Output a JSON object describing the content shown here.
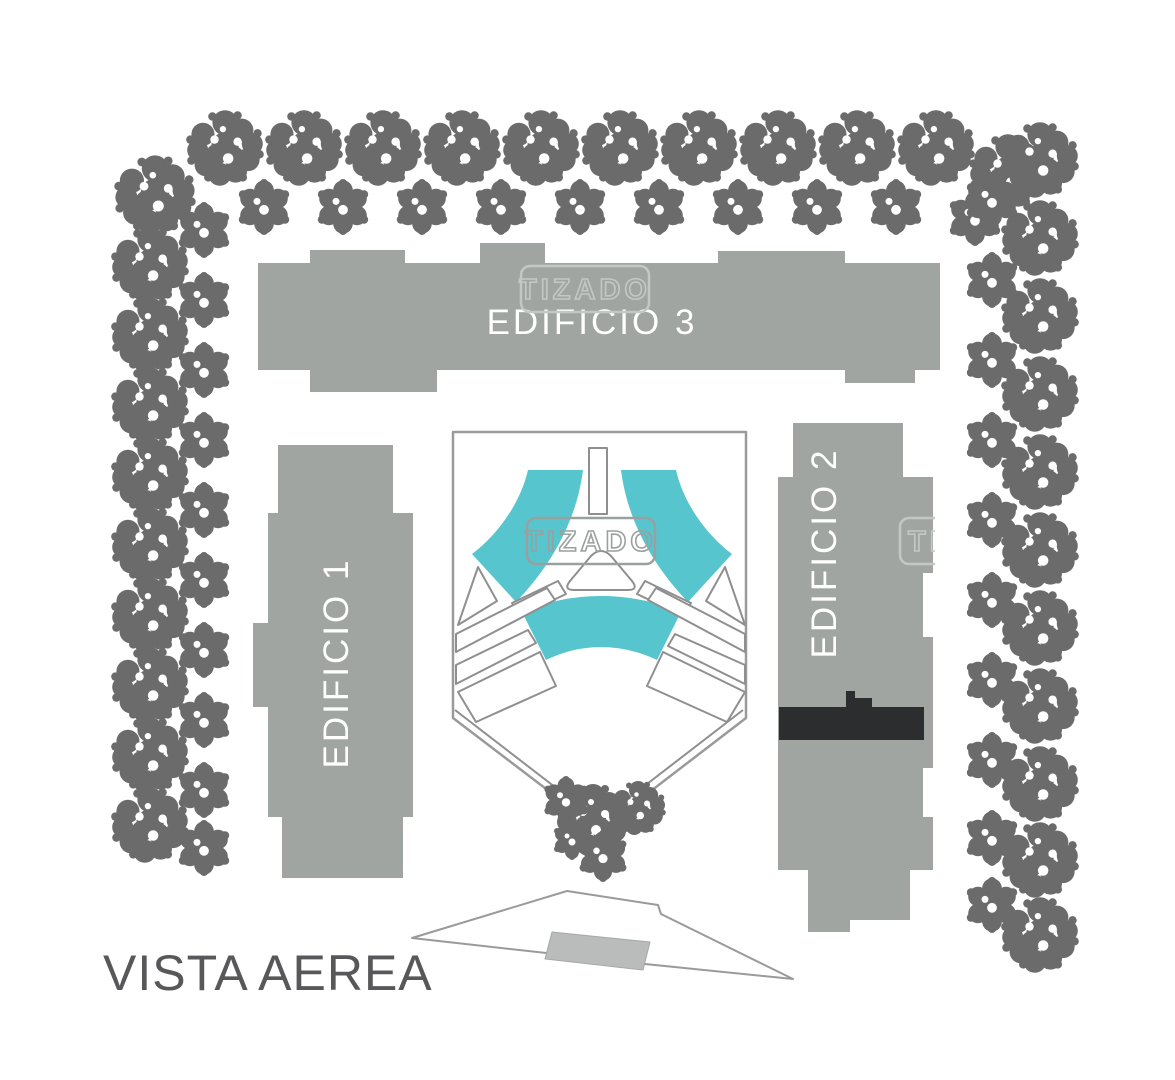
{
  "title": "VISTA AEREA",
  "watermark": {
    "text": "TIZADO"
  },
  "buildings": [
    {
      "id": "edificio-1",
      "label": "EDIFICIO 1"
    },
    {
      "id": "edificio-2",
      "label": "EDIFICIO 2"
    },
    {
      "id": "edificio-3",
      "label": "EDIFICIO 3"
    }
  ],
  "colors": {
    "background": "#ffffff",
    "building_gray": "#a0a5a2",
    "tree_gray": "#6b6b6b",
    "pool_teal": "#56c5ce",
    "dark_band": "#2b2d2e",
    "outline_gray": "#9a9a9a",
    "label_white": "#ffffff",
    "title_gray": "#58585a",
    "road_fill_gray": "#b9bcba"
  }
}
